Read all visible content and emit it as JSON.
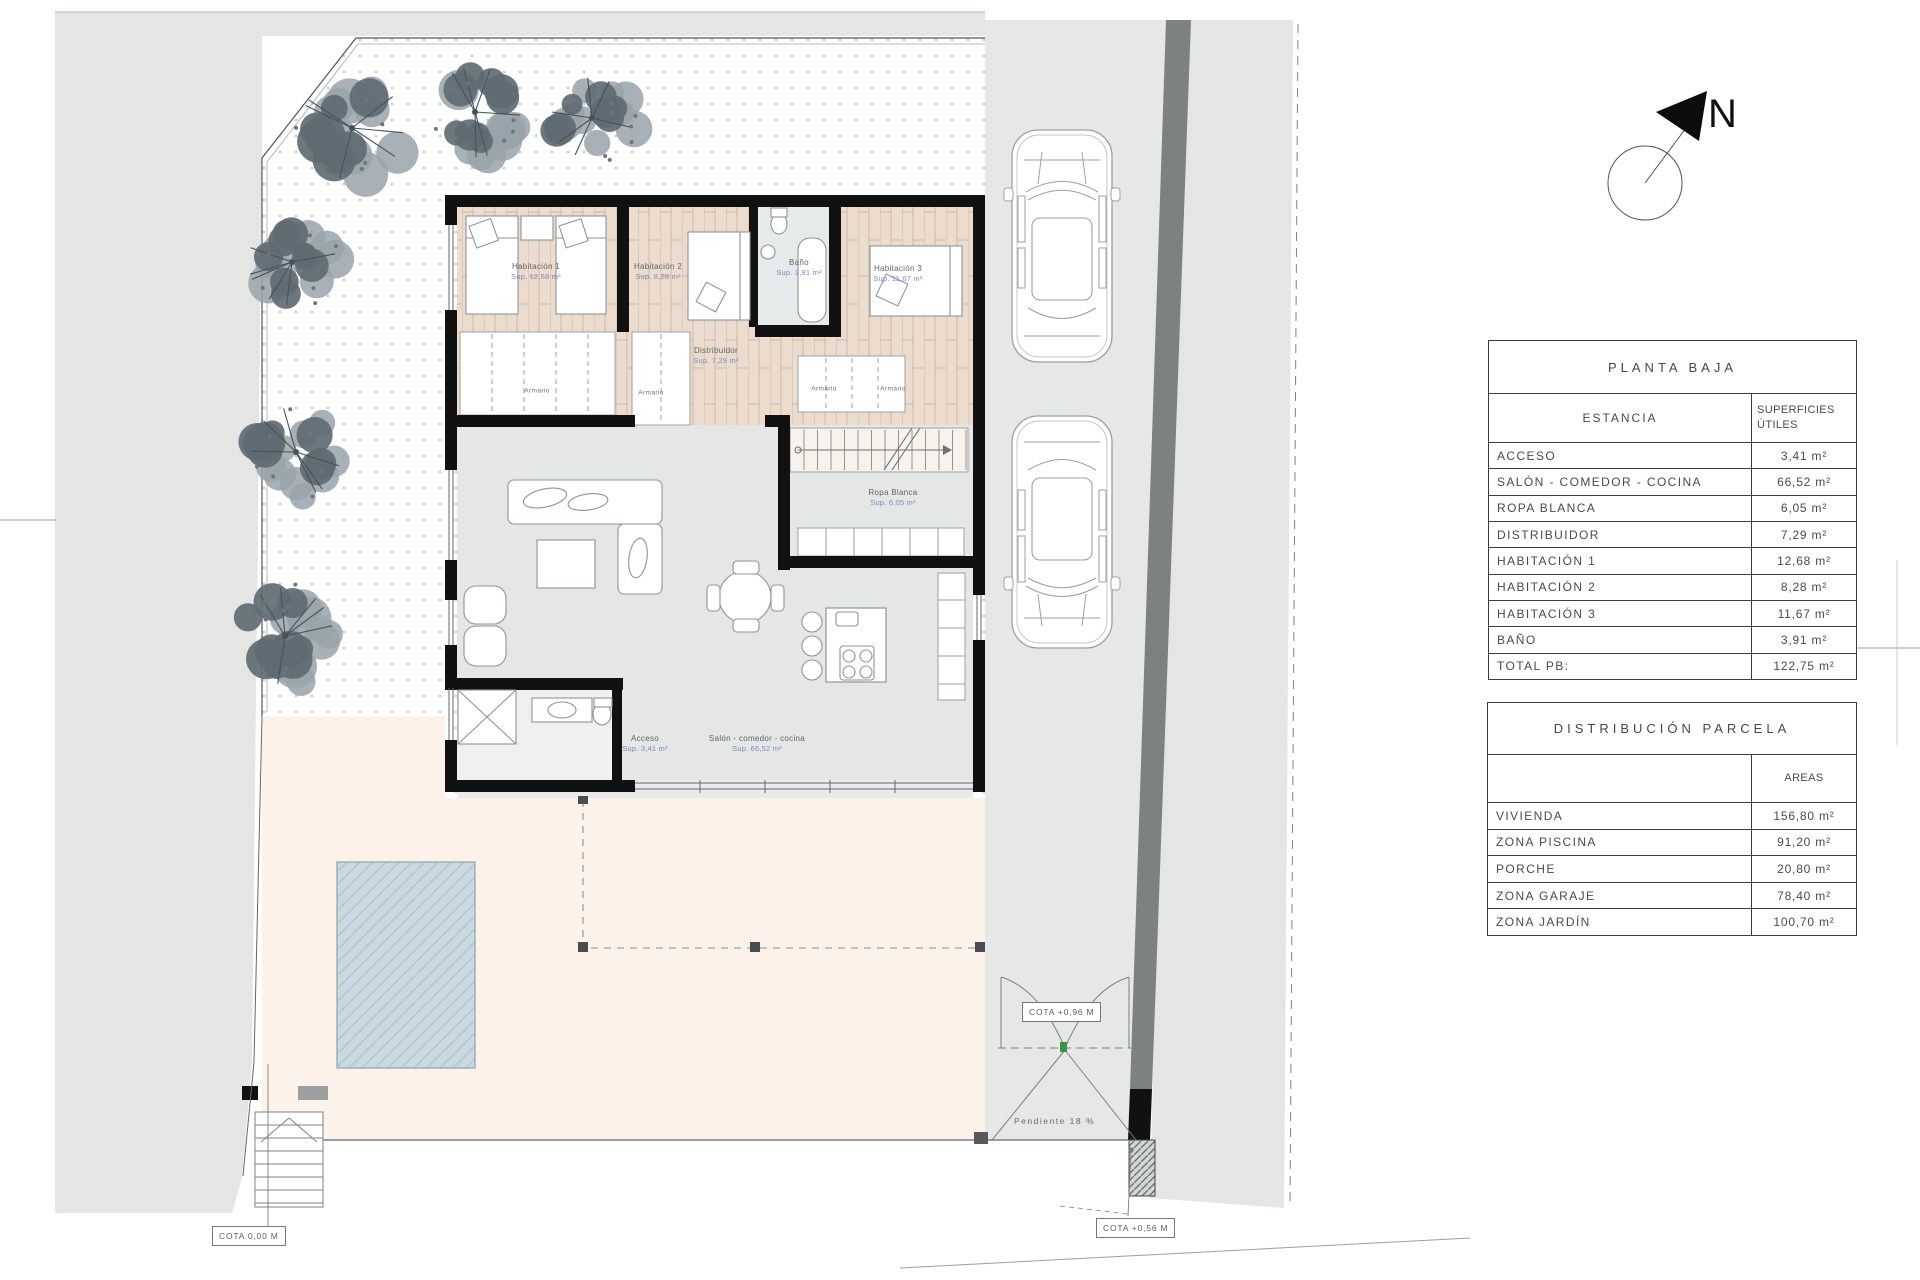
{
  "sheet": {
    "north_letter": "N",
    "labels": {
      "armario": "Armario",
      "pendiente": "Pendiente 18 %",
      "cota_street": "COTA 0,00 M",
      "cota_gate": "COTA +0,96 M",
      "cota_porch": "COTA +0,56 M"
    },
    "rooms": [
      {
        "name": "Habitación 1",
        "area": "Sup. 12,68 m²"
      },
      {
        "name": "Habitación 2",
        "area": "Sup. 8,28 m²"
      },
      {
        "name": "Baño",
        "area": "Sup. 3,91 m²"
      },
      {
        "name": "Habitación 3",
        "area": "Sup. 11,67 m²"
      },
      {
        "name": "Distribuidor",
        "area": "Sup. 7,29 m²"
      },
      {
        "name": "Ropa Blanca",
        "area": "Sup. 6,05 m²"
      },
      {
        "name": "Acceso",
        "area": "Sup. 3,41 m²"
      },
      {
        "name": "Salón - comedor - cocina",
        "area": "Sup. 66,52 m²"
      }
    ]
  },
  "tables": {
    "planta_baja": {
      "title": "PLANTA BAJA",
      "col_estancia": "ESTANCIA",
      "col_superficies": "SUPERFICIES\nÚTILES",
      "rows": [
        {
          "label": "ACCESO",
          "value": "3,41 m²"
        },
        {
          "label": "SALÓN - COMEDOR - COCINA",
          "value": "66,52 m²"
        },
        {
          "label": "ROPA BLANCA",
          "value": "6,05 m²"
        },
        {
          "label": "DISTRIBUIDOR",
          "value": "7,29 m²"
        },
        {
          "label": "HABITACIÓN 1",
          "value": "12,68 m²"
        },
        {
          "label": "HABITACIÓN 2",
          "value": "8,28 m²"
        },
        {
          "label": "HABITACIÓN 3",
          "value": "11,67 m²"
        },
        {
          "label": "BAÑO",
          "value": "3,91 m²"
        },
        {
          "label": "TOTAL PB:",
          "value": "122,75 m²"
        }
      ]
    },
    "distribucion_parcela": {
      "title": "DISTRIBUCIÓN PARCELA",
      "col_estancia": "",
      "col_areas": "AREAS",
      "rows": [
        {
          "label": "VIVIENDA",
          "value": "156,80 m²"
        },
        {
          "label": "ZONA PISCINA",
          "value": "91,20 m²"
        },
        {
          "label": "PORCHE",
          "value": "20,80 m²"
        },
        {
          "label": "ZONA GARAJE",
          "value": "78,40 m²"
        },
        {
          "label": "ZONA JARDÍN",
          "value": "100,70 m²"
        }
      ]
    }
  },
  "colors": {
    "neighbor": "#e4e6e4",
    "driveway": "#e6e8e7",
    "dark_wall": "#7d8281",
    "terrace": "#fcf2ea",
    "pool": "#c9d9df",
    "wood_floor": "#ecdccd",
    "wall": "#111111",
    "label_blue": "#7e88c0"
  }
}
